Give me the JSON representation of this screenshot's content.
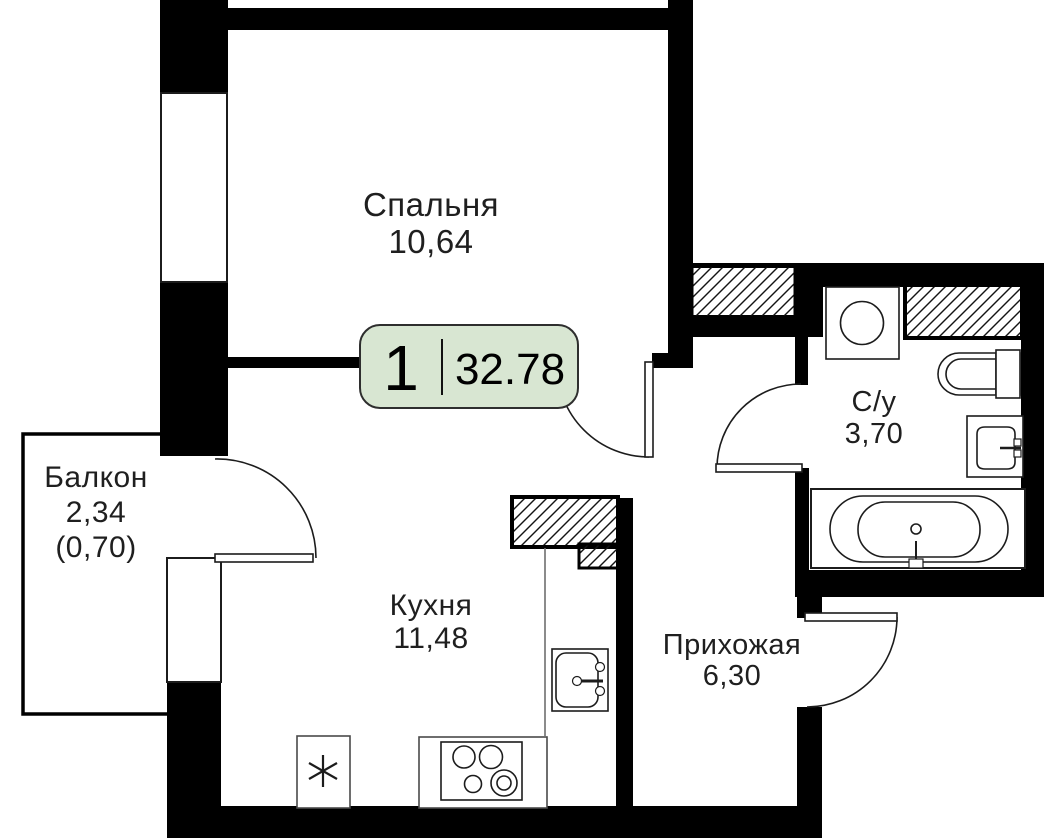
{
  "plan": {
    "title": "1-room apartment floor plan",
    "badge": {
      "rooms_count": "1",
      "total_area": "32.78"
    },
    "rooms": {
      "bedroom": {
        "name": "Спальня",
        "area": "10,64"
      },
      "balcony": {
        "name": "Балкон",
        "area": "2,34",
        "area_coef": "(0,70)"
      },
      "kitchen": {
        "name": "Кухня",
        "area": "11,48"
      },
      "hallway": {
        "name": "Прихожая",
        "area": "6,30"
      },
      "bathroom": {
        "name": "С/у",
        "area": "3,70"
      }
    },
    "fixtures": [
      "washing-machine-icon",
      "toilet-icon",
      "washbasin-icon",
      "bathtub-icon",
      "kitchen-sink-icon",
      "stove-icon",
      "fridge-icon"
    ],
    "colors": {
      "wall": "#000000",
      "stroke": "#1c1c1c",
      "badge_fill": "#d8e6d2",
      "badge_border": "#2e2e2e",
      "background": "#ffffff"
    }
  }
}
